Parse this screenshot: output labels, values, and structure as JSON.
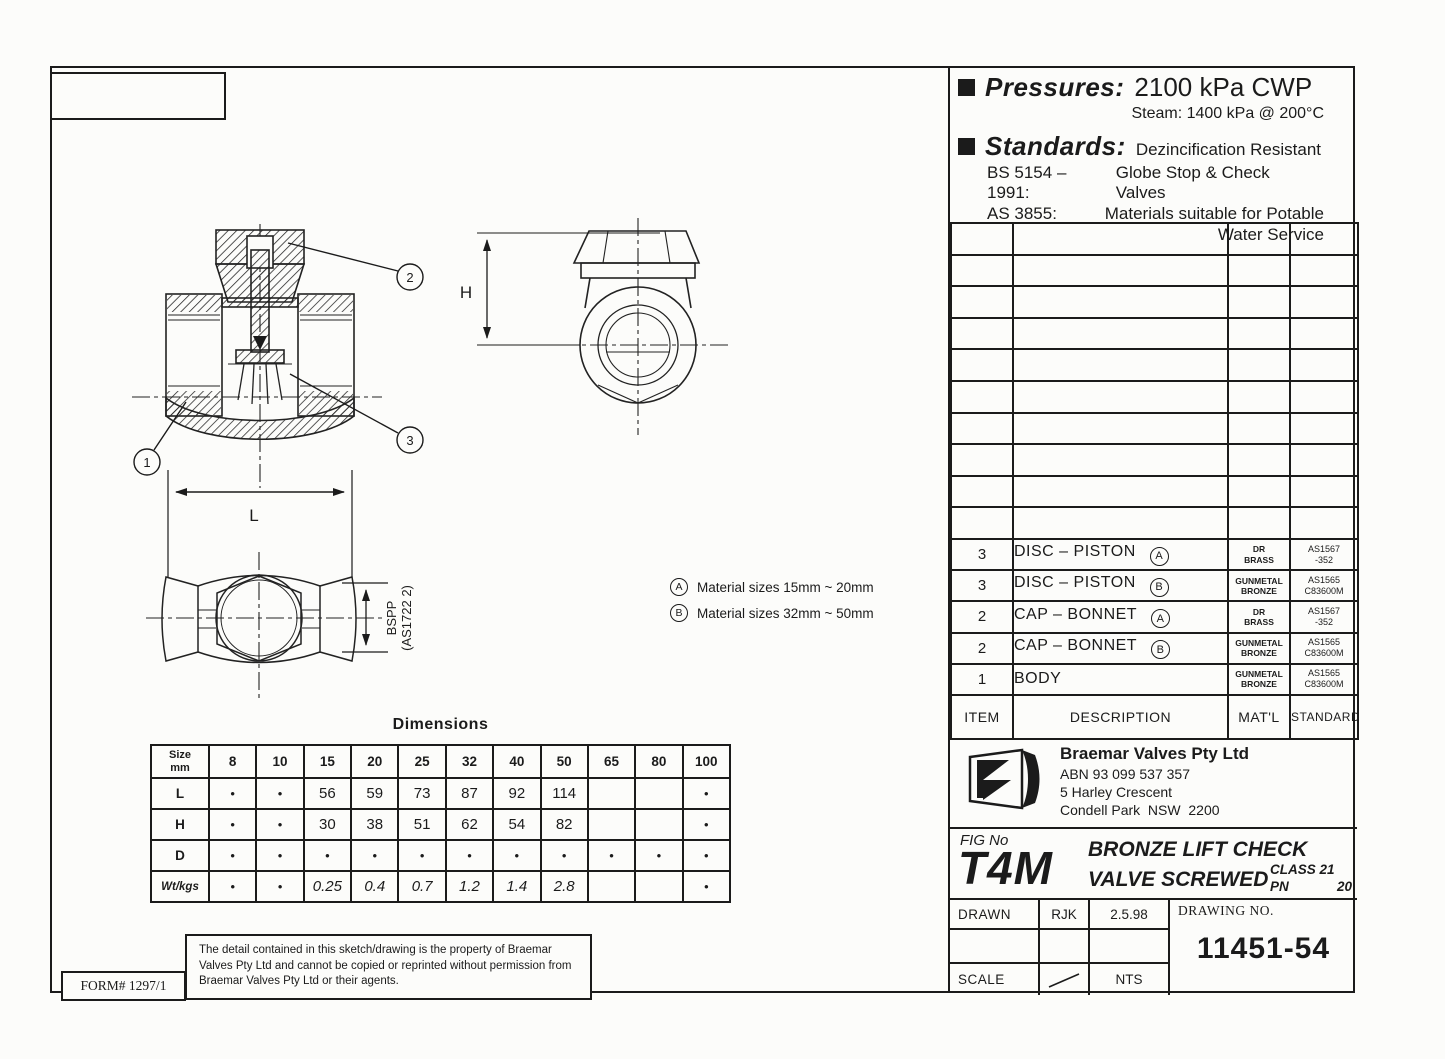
{
  "sheet": {
    "form_number": "FORM# 1297/1",
    "disclaimer": "The detail contained in this sketch/drawing is the property of Braemar Valves Pty Ltd and cannot be copied or reprinted without permission from Braemar Valves Pty Ltd or their agents."
  },
  "specs": {
    "pressures_label": "Pressures:",
    "pressures_value": "2100 kPa CWP",
    "steam_line": "Steam: 1400 kPa @ 200°C",
    "standards_label": "Standards:",
    "standards_value": "Dezincification Resistant",
    "standards_items": [
      {
        "code": "BS 5154 –1991:",
        "desc": "Globe Stop & Check Valves"
      },
      {
        "code": "AS 3855:",
        "desc": "Materials suitable for Potable"
      },
      {
        "code": "",
        "desc": "Water Service"
      }
    ]
  },
  "parts_table": {
    "empty_rows": 10,
    "header": {
      "item": "ITEM",
      "description": "DESCRIPTION",
      "material": "MAT'L",
      "standard": "STANDARD"
    },
    "rows": [
      {
        "item": "3",
        "description": "DISC – PISTON",
        "variant": "A",
        "material": [
          "DR",
          "BRASS"
        ],
        "standard": [
          "AS1567",
          "-352"
        ]
      },
      {
        "item": "3",
        "description": "DISC – PISTON",
        "variant": "B",
        "material": [
          "GUNMETAL",
          "BRONZE"
        ],
        "standard": [
          "AS1565",
          "C83600M"
        ]
      },
      {
        "item": "2",
        "description": "CAP – BONNET",
        "variant": "A",
        "material": [
          "DR",
          "BRASS"
        ],
        "standard": [
          "AS1567",
          "-352"
        ]
      },
      {
        "item": "2",
        "description": "CAP – BONNET",
        "variant": "B",
        "material": [
          "GUNMETAL",
          "BRONZE"
        ],
        "standard": [
          "AS1565",
          "C83600M"
        ]
      },
      {
        "item": "1",
        "description": "BODY",
        "variant": "",
        "material": [
          "GUNMETAL",
          "BRONZE"
        ],
        "standard": [
          "AS1565",
          "C83600M"
        ]
      }
    ]
  },
  "notes": [
    {
      "key": "A",
      "text": "Material sizes 15mm ~ 20mm"
    },
    {
      "key": "B",
      "text": "Material sizes 32mm ~ 50mm"
    }
  ],
  "dimensions_table": {
    "title": "Dimensions",
    "size_label_line1": "Size",
    "size_label_line2": "mm",
    "sizes": [
      "8",
      "10",
      "15",
      "20",
      "25",
      "32",
      "40",
      "50",
      "65",
      "80",
      "100"
    ],
    "rows": [
      {
        "label": "L",
        "values": [
          "•",
          "•",
          "56",
          "59",
          "73",
          "87",
          "92",
          "114",
          "",
          "",
          "•"
        ]
      },
      {
        "label": "H",
        "values": [
          "•",
          "•",
          "30",
          "38",
          "51",
          "62",
          "54",
          "82",
          "",
          "",
          "•"
        ]
      },
      {
        "label": "D",
        "values": [
          "•",
          "•",
          "•",
          "•",
          "•",
          "•",
          "•",
          "•",
          "•",
          "•",
          "•"
        ]
      },
      {
        "label": "Wt/kgs",
        "values": [
          "•",
          "•",
          "0.25",
          "0.4",
          "0.7",
          "1.2",
          "1.4",
          "2.8",
          "",
          "",
          "•"
        ]
      }
    ]
  },
  "title_block": {
    "company": "Braemar Valves Pty Ltd",
    "abn": "ABN 93 099 537 357",
    "address_line1": "5 Harley Crescent",
    "address_line2": "Condell Park  NSW  2200",
    "fig_label": "FIG No",
    "fig_no": "T4M",
    "product_line1": "BRONZE LIFT CHECK",
    "product_line2": "VALVE SCREWED",
    "class_line": "CLASS 21",
    "pn_label": "PN",
    "pn_value": "20",
    "drawn_label": "DRAWN",
    "drawn_by": "RJK",
    "drawn_date": "2.5.98",
    "drawing_no_label": "DRAWING NO.",
    "drawing_no": "11451-54",
    "scale_label": "SCALE",
    "scale_value": "NTS"
  },
  "drawing": {
    "callout_1": "1",
    "callout_2": "2",
    "callout_3": "3",
    "dim_length_label": "L",
    "dim_height_label": "H",
    "thread_label": "BSPP",
    "thread_standard": "(AS1722 2)"
  },
  "colors": {
    "ink": "#1b1b1b",
    "paper": "#fcfcfa"
  }
}
